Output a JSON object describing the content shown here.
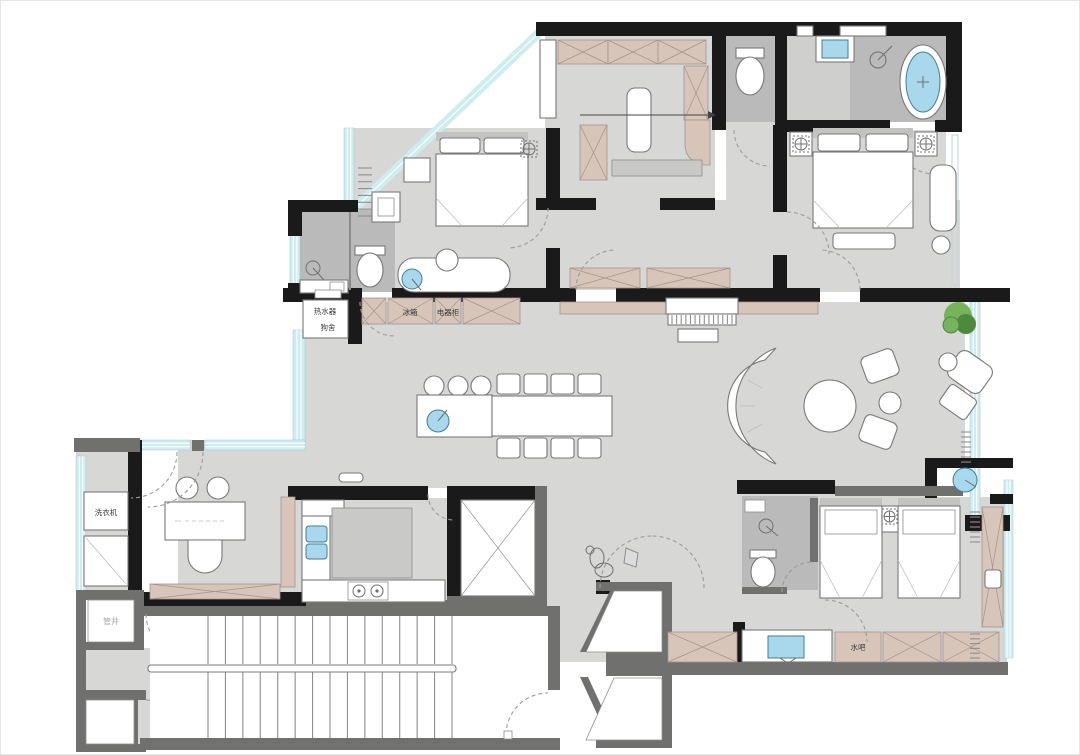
{
  "title": "apartment-floor-plan",
  "labels": {
    "water_heater": "热水器",
    "dog_house": "狗舍",
    "fridge": "冰箱",
    "appliance_cabinet": "电器柜",
    "washing_machine": "洗衣机",
    "pipe_shaft": "管井",
    "water_bar": "水吧"
  },
  "colors": {
    "floor": "#d7d8d6",
    "floor_dark": "#c9cac8",
    "bath": "#b9bab9",
    "bath_light": "#cfd0ce",
    "wall": "#1a1a1a",
    "wall_gray": "#70716f",
    "cabinet": "#d8c5b9",
    "cabinet_line": "#a3938a",
    "window": "#cdedf0",
    "window_frame": "#9fc9cc",
    "blue": "#a9d8ec",
    "blue_stroke": "#3f7d9b",
    "plant": "#76b35a",
    "plant_dark": "#4d8a3a",
    "arc": "#9b9b9b",
    "text": "#3a3a3a"
  }
}
